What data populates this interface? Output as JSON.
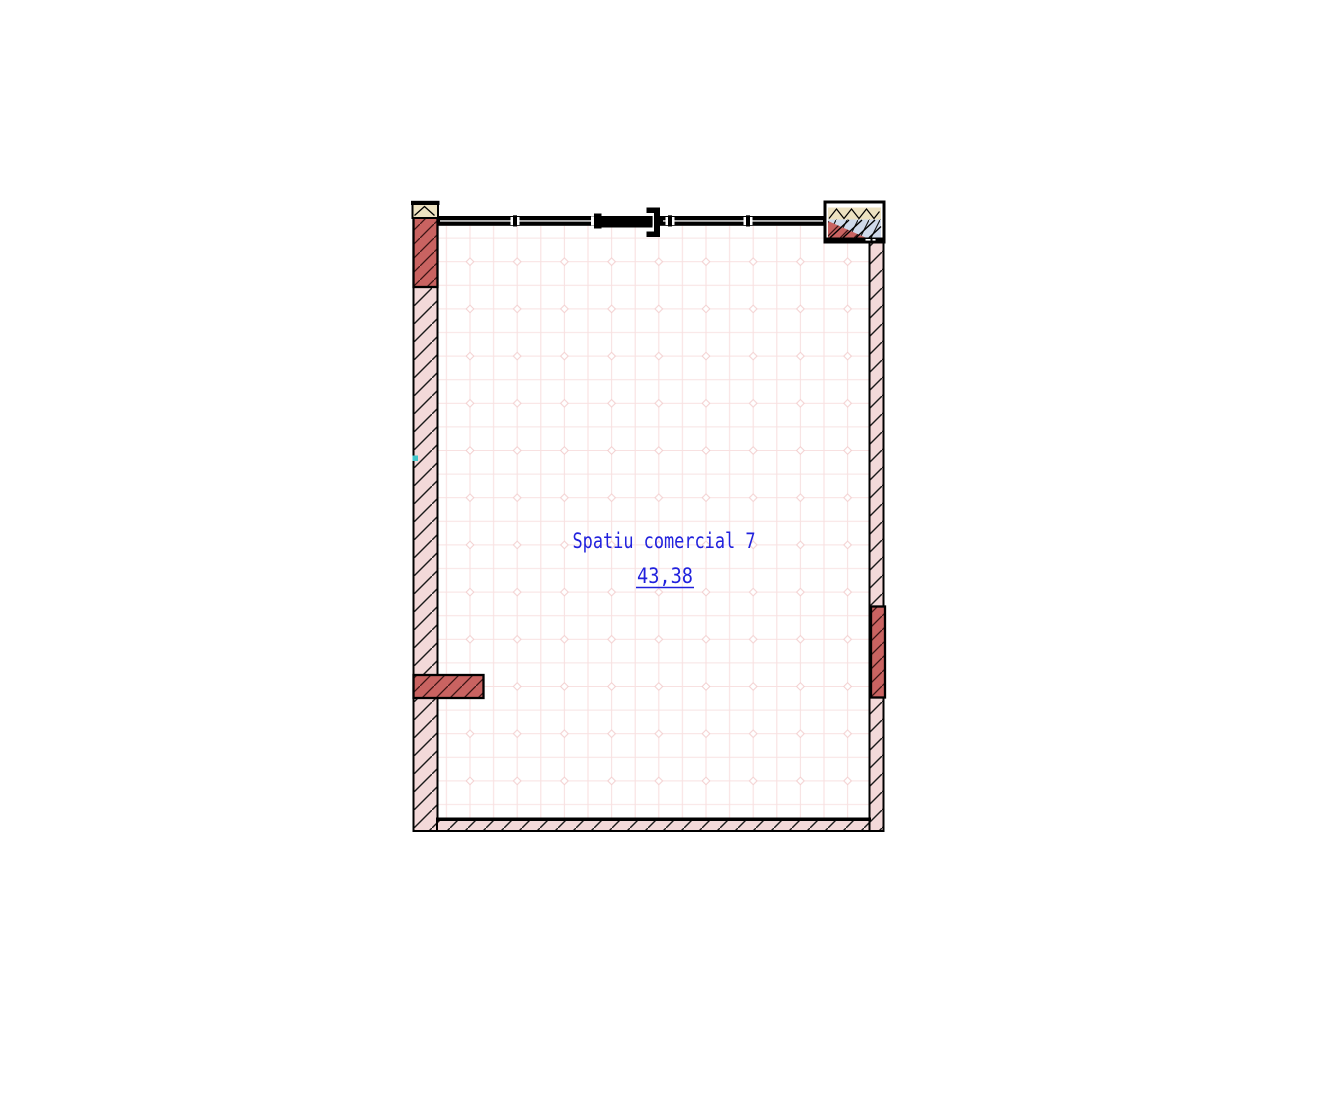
{
  "plan": {
    "room": {
      "name": "Spatiu comercial 7",
      "area": "43,38"
    },
    "colors": {
      "wall_fill": "#f3d9d9",
      "pier_fill": "#c96361",
      "insulation_fill": "#ede2c1",
      "glazing_fill": "#cfd9ea",
      "floor_grid": "#f8e1e1",
      "label": "#2121dd",
      "line": "#000000",
      "grip": "#3fc6cb"
    }
  }
}
